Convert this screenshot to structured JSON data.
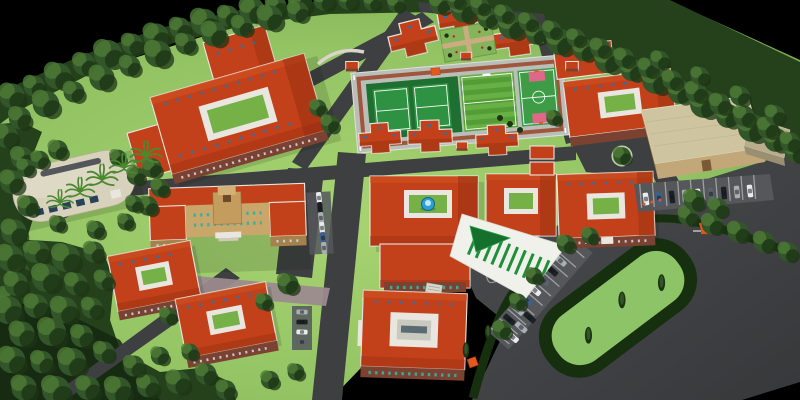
{
  "scene": {
    "label": "Aerial 3D architectural rendering of a campus masterplan surrounded by a forest tree belt on a black backdrop",
    "environment": {
      "backdrop": "black",
      "perimeter": "dense tree belt with boundary road",
      "ground": "landscaped lawns, asphalt service roads and a large dark asphalt apron"
    },
    "sports_complex": {
      "tennis_courts": 2,
      "football_pitch": 1,
      "basketball_court": 1,
      "platform": "light grey deck with red-brown running border"
    },
    "buildings": {
      "dormitory_villas": 6,
      "courtyard_blocks": 6,
      "main_block_with_fountain_courtyard": 1,
      "administration_building": 1,
      "domed_auditorium": 1,
      "multipurpose_hall": 1,
      "guard_hut": 1,
      "garden_pavilions": 4
    },
    "landscape_features": {
      "formal_garden": 1,
      "flower_island": 1,
      "hedged_paddock": 1,
      "roundabout": 1,
      "palm_trees": 5,
      "blue_fountain": 1,
      "green_striped_canopy": 1,
      "orange_gate_marker": 1
    },
    "vehicles": {
      "parking_areas": 4,
      "cars": 30
    }
  },
  "colors": {
    "background": "#000000",
    "lawn_light": "#a8d472",
    "lawn_mid": "#93c363",
    "lawn_dark": "#6fa24c",
    "forest_base": "#24411b",
    "tree_dark": "#1c3414",
    "tree_mid": "#33552a",
    "tree_light": "#4d7a36",
    "hedge_dark": "#16300f",
    "road_asphalt": "#3d3f41",
    "apron_asphalt": "#454749",
    "path_mauve": "#9b8a8e",
    "roof_red": "#c3411a",
    "roof_red_light": "#d25324",
    "roof_red_dark": "#8e2c10",
    "eave_white": "#e9e6df",
    "brick_wall": "#7c4231",
    "brick_dark": "#58291c",
    "window_teal": "#35b0a0",
    "skylight_blue": "#2f6fa6",
    "courtyard_green": "#76b148",
    "cream_building": "#d8d2bd",
    "tan_building": "#c9a76a",
    "tan_dark": "#a5824c",
    "hall_roof": "#cfc4a0",
    "hall_wall": "#c2a878",
    "court_green": "#2e9242",
    "court_green_dark": "#1f7030",
    "pitch_stripe_a": "#549c36",
    "pitch_stripe_b": "#68b046",
    "basketball_pink": "#e06788",
    "platform_gray": "#b9beb8",
    "track_red": "#9c4a30",
    "canopy_white": "#f1f1ec",
    "canopy_green": "#1f8f3a",
    "triangle_green": "#14702c",
    "fountain_blue": "#2d9fd4",
    "fountain_light": "#bfe8f5",
    "flower_red": "#c02330",
    "flower_white": "#e9e9e9",
    "hut_orange": "#e2591c",
    "stall_gray": "#55575a",
    "car_white": "#e9ebec",
    "car_black": "#1c2125",
    "car_silver": "#a9afb4",
    "car_blue": "#3d5f8c",
    "car_gray": "#5a636b"
  }
}
